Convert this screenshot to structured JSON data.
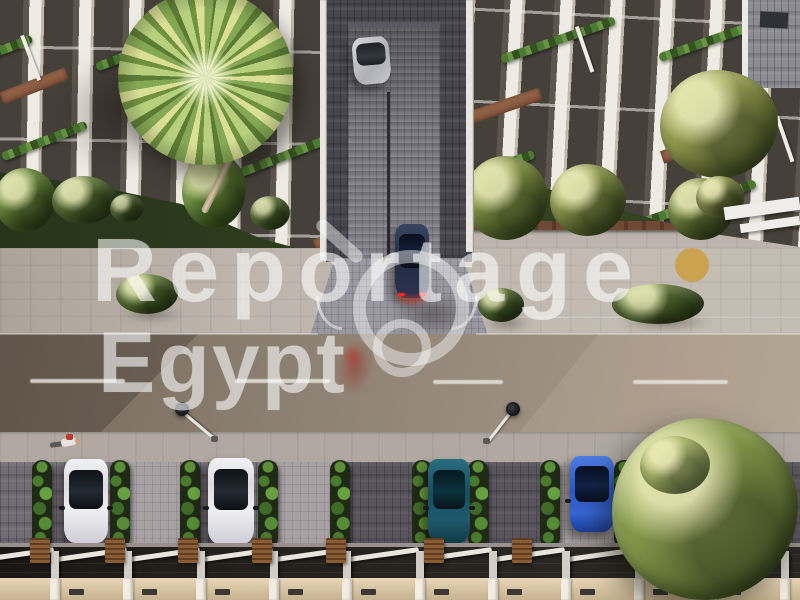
{
  "meta": {
    "type": "aerial-3d-architectural-render",
    "subject": "Top-down aerial render of a residential compound: two white apartment buildings with planted balconies, central cobblestone driveway, street with lane markings, parking row with hedge planters and carports",
    "width_px": 800,
    "height_px": 600
  },
  "watermark": {
    "line1": "Reportage",
    "line2": "Egypt",
    "text_color": "rgba(255,255,255,0.52)",
    "dot_color": "#cb9e42",
    "logo_icon": "double-ring-with-handle-watermark"
  },
  "scene": {
    "palette": {
      "road_asphalt": "#8d8174",
      "sidewalk": "#beb6ad",
      "driveway_cobble": "#7b7a83",
      "garden_grass": "#2e3e1d",
      "hedge_green": "#4a7a2e",
      "carport_roof": "#221f1b",
      "carport_wall": "#dcc9a9",
      "building_slab_white": "#eeebe4",
      "terracotta_terrace": "#9a6a4e",
      "car_white": "#e9e8ea",
      "car_teal": "#1d5a6e",
      "car_blue": "#2f63cf",
      "car_navy_exiting": "#2a3450",
      "car_silver": "#c3c4c7",
      "taillight_red": "#ff2a1a"
    },
    "elements": [
      "left apartment building with stepped balconies and plants",
      "right apartment building with stepped balconies and olive trees",
      "large palm tree on left building",
      "central cobblestone driveway with silver car and navy car exiting",
      "asphalt street with dashed center line and two street lamps",
      "person lying on pavement",
      "parking row: white car, white car, teal car, blue car with hedge planters",
      "row of carports with white beams and beige wall",
      "large tree at bottom right"
    ]
  }
}
